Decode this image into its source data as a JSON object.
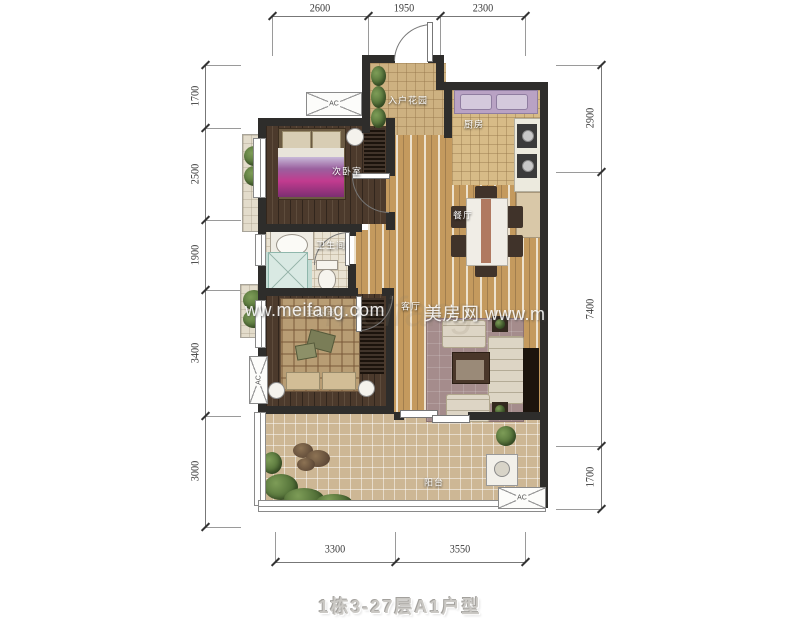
{
  "title": "1栋3-27层A1户型",
  "watermarks": {
    "big_faint": "meifang",
    "left": "ww.meifang.com",
    "right": "美房网 www.m"
  },
  "rooms": {
    "entry_garden": "入户花园",
    "kitchen": "厨房",
    "bedroom2": "次卧室",
    "bathroom": "卫生间",
    "dining": "餐厅",
    "living": "客厅",
    "master_bedroom": "主卧室",
    "balcony": "阳台"
  },
  "ac_label": "AC",
  "dimensions": {
    "top": [
      "2600",
      "1950",
      "2300"
    ],
    "left": [
      "1700",
      "2500",
      "1900",
      "3400",
      "3000"
    ],
    "right": [
      "2900",
      "7400",
      "1700"
    ],
    "bottom": [
      "3300",
      "3550"
    ]
  }
}
